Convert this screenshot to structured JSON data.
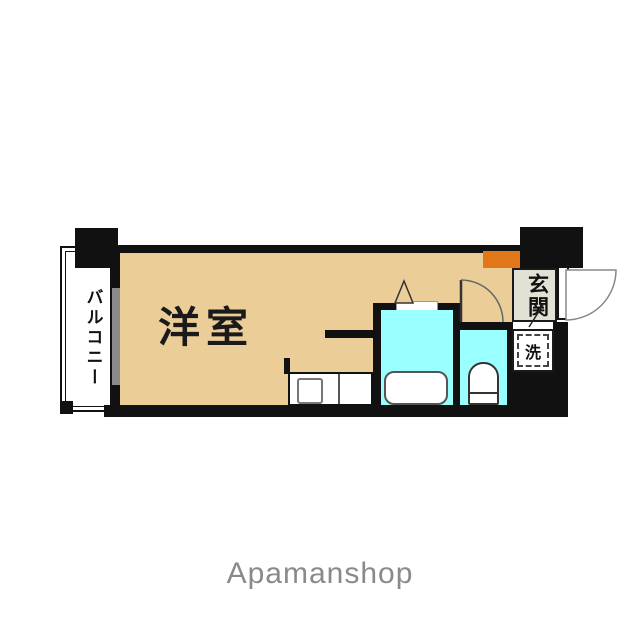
{
  "floorplan": {
    "title": "studio apartment floor plan",
    "rooms": {
      "living": {
        "label": "洋室"
      },
      "balcony": {
        "label": "バルコニー"
      },
      "entrance": {
        "label": "玄関"
      },
      "laundry": {
        "label": "洗"
      }
    },
    "fixtures": [
      "bathtub",
      "toilet",
      "kitchen-sink",
      "washer-space",
      "entrance-door-swing",
      "room-door-swing",
      "bath-folding-door",
      "balcony-window"
    ],
    "colors": {
      "floor_tan": "#EBCD98",
      "wet_area_cyan": "#99FFFF",
      "accent_orange": "#E07819",
      "entrance_floor": "#E3E0D6",
      "wall": "#111111",
      "window_glass": "#8A8A8A",
      "brand_text": "#8A8A8A"
    }
  },
  "footer": {
    "brand": "Apamanshop"
  }
}
